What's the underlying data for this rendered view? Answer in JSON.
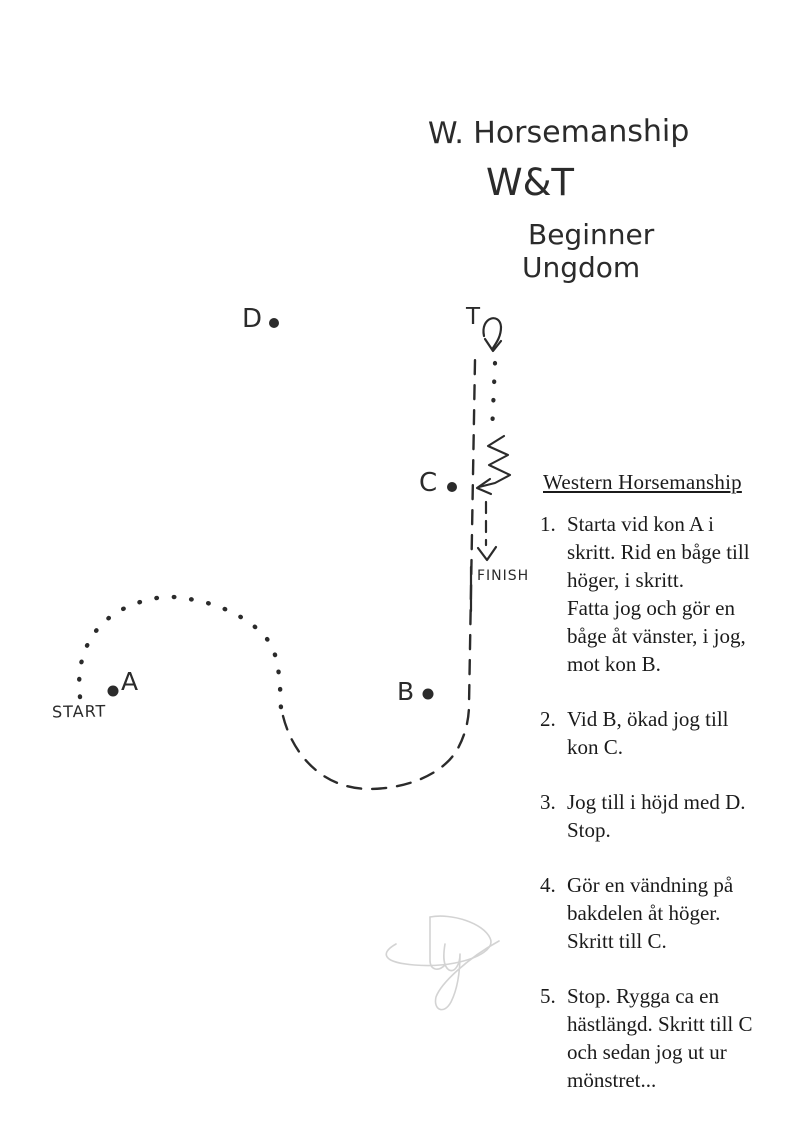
{
  "paper": {
    "background_color": "#ffffff",
    "ink_color": "#2b2b2b",
    "text_color": "#1b1b1b",
    "signature_color": "#c9c9c9"
  },
  "title": {
    "line1": "W. Horsemanship",
    "line2": "W&T",
    "line3": "Beginner",
    "line4": "Ungdom"
  },
  "diagram": {
    "labels": {
      "cone_d": "D",
      "cone_c": "C",
      "cone_b": "B",
      "cone_a": "A",
      "turn": "T",
      "start": "START",
      "finish": "FINISH"
    },
    "symbols": [
      "walk-dotted-arc",
      "jog-dashed-line",
      "turn-on-haunches-arrow",
      "back-up-zigzag-arrow",
      "finish-dashed-arrow",
      "pencil-signature"
    ]
  },
  "instructions": {
    "heading": "Western Horsemanship",
    "items": [
      {
        "num": "1.",
        "text": "Starta vid kon A i\nskritt. Rid en båge till\nhöger, i skritt.\nFatta jog och gör en\nbåge åt vänster, i jog,\nmot kon B."
      },
      {
        "num": "2.",
        "text": "Vid B, ökad jog till\nkon C."
      },
      {
        "num": "3.",
        "text": "Jog till i höjd med D.\nStop."
      },
      {
        "num": "4.",
        "text": "Gör en vändning på\nbakdelen åt höger.\nSkritt till C."
      },
      {
        "num": "5.",
        "text": "Stop. Rygga ca en\nhästlängd. Skritt till C\noch sedan jog ut ur\nmönstret..."
      }
    ]
  }
}
